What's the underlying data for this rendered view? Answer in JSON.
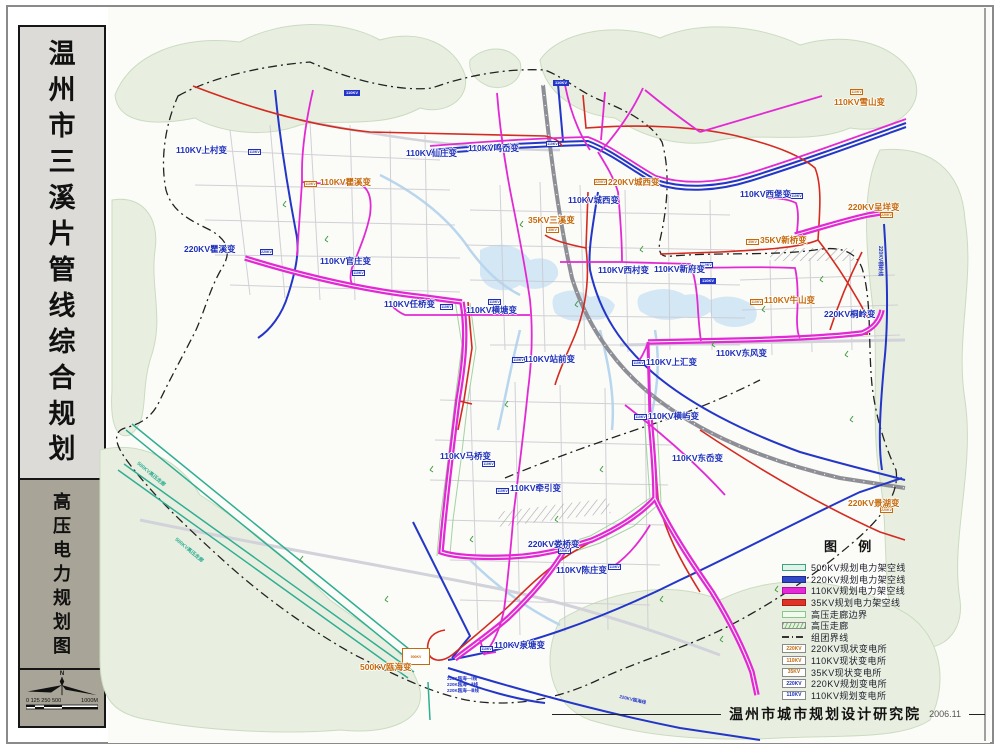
{
  "sidebar": {
    "title_chars": [
      "温",
      "州",
      "市",
      "三",
      "溪",
      "片",
      "管",
      "线",
      "综",
      "合",
      "规",
      "划"
    ],
    "subtitle_chars": [
      "高",
      "压",
      "电",
      "力",
      "规",
      "划",
      "图"
    ],
    "compass_label": "N",
    "scale_left": "0 125 250  500",
    "scale_right": "1000M"
  },
  "colors": {
    "planned_text": "#1d2fb8",
    "existing_text": "#c5690a",
    "line_500kv": "#2fae93",
    "line_220kv": "#2436c8",
    "line_110kv": "#e22ad4",
    "line_35kv": "#d42a20"
  },
  "map": {
    "substations": [
      {
        "name": "110KV上村变",
        "x": 176,
        "y": 146,
        "kind": "p",
        "marker": {
          "x": 248,
          "y": 149,
          "tag": "110KV"
        }
      },
      {
        "name": "110KV仙庄变",
        "x": 406,
        "y": 149,
        "kind": "p"
      },
      {
        "name": "110KV鸣岙变",
        "x": 468,
        "y": 144,
        "kind": "p",
        "marker": {
          "x": 546,
          "y": 141,
          "tag": "110KV"
        }
      },
      {
        "name": "220KV城西变",
        "x": 608,
        "y": 178,
        "kind": "e",
        "marker": {
          "x": 594,
          "y": 179,
          "tag": "220KV"
        }
      },
      {
        "name": "110KV城西变",
        "x": 568,
        "y": 196,
        "kind": "p"
      },
      {
        "name": "220KV瞿溪变",
        "x": 184,
        "y": 245,
        "kind": "p",
        "marker": {
          "x": 260,
          "y": 249,
          "tag": "220KV"
        }
      },
      {
        "name": "110KV瞿溪变",
        "x": 320,
        "y": 178,
        "kind": "e",
        "marker": {
          "x": 304,
          "y": 181,
          "tag": "110KV"
        }
      },
      {
        "name": "110KV官庄变",
        "x": 320,
        "y": 257,
        "kind": "p",
        "marker": {
          "x": 352,
          "y": 270,
          "tag": "110KV"
        }
      },
      {
        "name": "110KV任桥变",
        "x": 384,
        "y": 300,
        "kind": "p",
        "marker": {
          "x": 440,
          "y": 304,
          "tag": "110KV"
        }
      },
      {
        "name": "110KV横塘变",
        "x": 466,
        "y": 306,
        "kind": "p",
        "marker": {
          "x": 488,
          "y": 299,
          "tag": "110KV"
        }
      },
      {
        "name": "35KV三溪变",
        "x": 528,
        "y": 216,
        "kind": "e",
        "marker": {
          "x": 546,
          "y": 227,
          "tag": "35KV"
        }
      },
      {
        "name": "110KV西村变",
        "x": 598,
        "y": 266,
        "kind": "p"
      },
      {
        "name": "110KV新府变",
        "x": 654,
        "y": 265,
        "kind": "p",
        "marker": {
          "x": 700,
          "y": 262,
          "tag": "110KV"
        }
      },
      {
        "name": "110KV西堡变",
        "x": 740,
        "y": 190,
        "kind": "p",
        "marker": {
          "x": 790,
          "y": 193,
          "tag": "110KV"
        }
      },
      {
        "name": "220KV呈垟变",
        "x": 848,
        "y": 203,
        "kind": "e",
        "marker": {
          "x": 880,
          "y": 212,
          "tag": "220KV"
        }
      },
      {
        "name": "110KV雪山变",
        "x": 834,
        "y": 98,
        "kind": "e",
        "marker": {
          "x": 850,
          "y": 89,
          "tag": "110KV"
        }
      },
      {
        "name": "35KV新桥变",
        "x": 760,
        "y": 236,
        "kind": "e",
        "marker": {
          "x": 746,
          "y": 239,
          "tag": "35KV"
        }
      },
      {
        "name": "110KV牛山变",
        "x": 764,
        "y": 296,
        "kind": "e",
        "marker": {
          "x": 750,
          "y": 299,
          "tag": "110KV"
        }
      },
      {
        "name": "220KV桐岭变",
        "x": 824,
        "y": 310,
        "kind": "p"
      },
      {
        "name": "110KV站前变",
        "x": 524,
        "y": 355,
        "kind": "p",
        "marker": {
          "x": 512,
          "y": 357,
          "tag": "110KV"
        }
      },
      {
        "name": "110KV上汇变",
        "x": 646,
        "y": 358,
        "kind": "p",
        "marker": {
          "x": 632,
          "y": 360,
          "tag": "110KV"
        }
      },
      {
        "name": "110KV东风变",
        "x": 716,
        "y": 349,
        "kind": "p"
      },
      {
        "name": "110KV横屿变",
        "x": 648,
        "y": 412,
        "kind": "p",
        "marker": {
          "x": 634,
          "y": 414,
          "tag": "110KV"
        }
      },
      {
        "name": "110KV东岙变",
        "x": 672,
        "y": 454,
        "kind": "p"
      },
      {
        "name": "110KV马桥变",
        "x": 440,
        "y": 452,
        "kind": "p",
        "marker": {
          "x": 482,
          "y": 461,
          "tag": "110KV"
        }
      },
      {
        "name": "110KV牵引变",
        "x": 510,
        "y": 484,
        "kind": "p",
        "marker": {
          "x": 496,
          "y": 488,
          "tag": "110KV"
        }
      },
      {
        "name": "220KV娄桥变",
        "x": 528,
        "y": 540,
        "kind": "p",
        "marker": {
          "x": 558,
          "y": 548,
          "tag": "220KV"
        }
      },
      {
        "name": "110KV陈庄变",
        "x": 556,
        "y": 566,
        "kind": "p",
        "marker": {
          "x": 608,
          "y": 564,
          "tag": "110KV"
        }
      },
      {
        "name": "110KV泉塘变",
        "x": 494,
        "y": 641,
        "kind": "p",
        "marker": {
          "x": 480,
          "y": 646,
          "tag": "110KV"
        }
      },
      {
        "name": "500KV瓯海变",
        "x": 360,
        "y": 663,
        "kind": "e",
        "marker": {
          "x": 402,
          "y": 648,
          "w": 28,
          "h": 17,
          "tag": "500KV"
        }
      },
      {
        "name": "220KV景湖变",
        "x": 848,
        "y": 499,
        "kind": "e",
        "marker": {
          "x": 880,
          "y": 507,
          "tag": "220KV"
        }
      }
    ],
    "line_tags": [
      {
        "text": "110KV",
        "x": 344,
        "y": 90
      },
      {
        "text": "110KV",
        "x": 553,
        "y": 80
      },
      {
        "text": "110KV",
        "x": 700,
        "y": 278
      }
    ],
    "annotations": [
      {
        "text": "500KV高压走廊",
        "x": 140,
        "y": 460,
        "rot": 40,
        "color": "#2fae93",
        "size": 5
      },
      {
        "text": "500KV高压走廊",
        "x": 178,
        "y": 536,
        "rot": 40,
        "color": "#2fae93",
        "size": 5
      },
      {
        "text": "220KV桐岭线",
        "x": 884,
        "y": 246,
        "rot": 90,
        "color": "#2436c8",
        "size": 5
      },
      {
        "text": "220K瓯海—Ⅰ线",
        "x": 447,
        "y": 676,
        "rot": 0,
        "color": "#2436c8",
        "size": 4.5
      },
      {
        "text": "220K瓯海—Ⅱ线",
        "x": 447,
        "y": 682,
        "rot": 0,
        "color": "#2436c8",
        "size": 4.5
      },
      {
        "text": "220K瓯海—Ⅲ线",
        "x": 447,
        "y": 688,
        "rot": 0,
        "color": "#2436c8",
        "size": 4.5
      },
      {
        "text": "220KV瓯海线",
        "x": 620,
        "y": 694,
        "rot": 13,
        "color": "#2436c8",
        "size": 4.5
      }
    ]
  },
  "legend": {
    "title": "图  例",
    "items": [
      {
        "label": "500KV规划电力架空线",
        "swatch": "b500"
      },
      {
        "label": "220KV规划电力架空线",
        "swatch": "b220"
      },
      {
        "label": "110KV规划电力架空线",
        "swatch": "b110"
      },
      {
        "label": "35KV规划电力架空线",
        "swatch": "b35"
      },
      {
        "label": "高压走廊边界",
        "swatch": "cedge"
      },
      {
        "label": "高压走廊",
        "swatch": "corr"
      },
      {
        "label": "组团界线",
        "swatch": "cluster"
      },
      {
        "label": "220KV现状变电所",
        "swatch": "subE",
        "tag": "220KV"
      },
      {
        "label": "110KV现状变电所",
        "swatch": "subE",
        "tag": "110KV"
      },
      {
        "label": "35KV现状变电所",
        "swatch": "subE",
        "tag": "35KV"
      },
      {
        "label": "220KV规划变电所",
        "swatch": "subP",
        "tag": "220KV"
      },
      {
        "label": "110KV规划变电所",
        "swatch": "subP",
        "tag": "110KV"
      }
    ]
  },
  "footer": {
    "credit": "温州市城市规划设计研究院",
    "date": "2006.11"
  }
}
